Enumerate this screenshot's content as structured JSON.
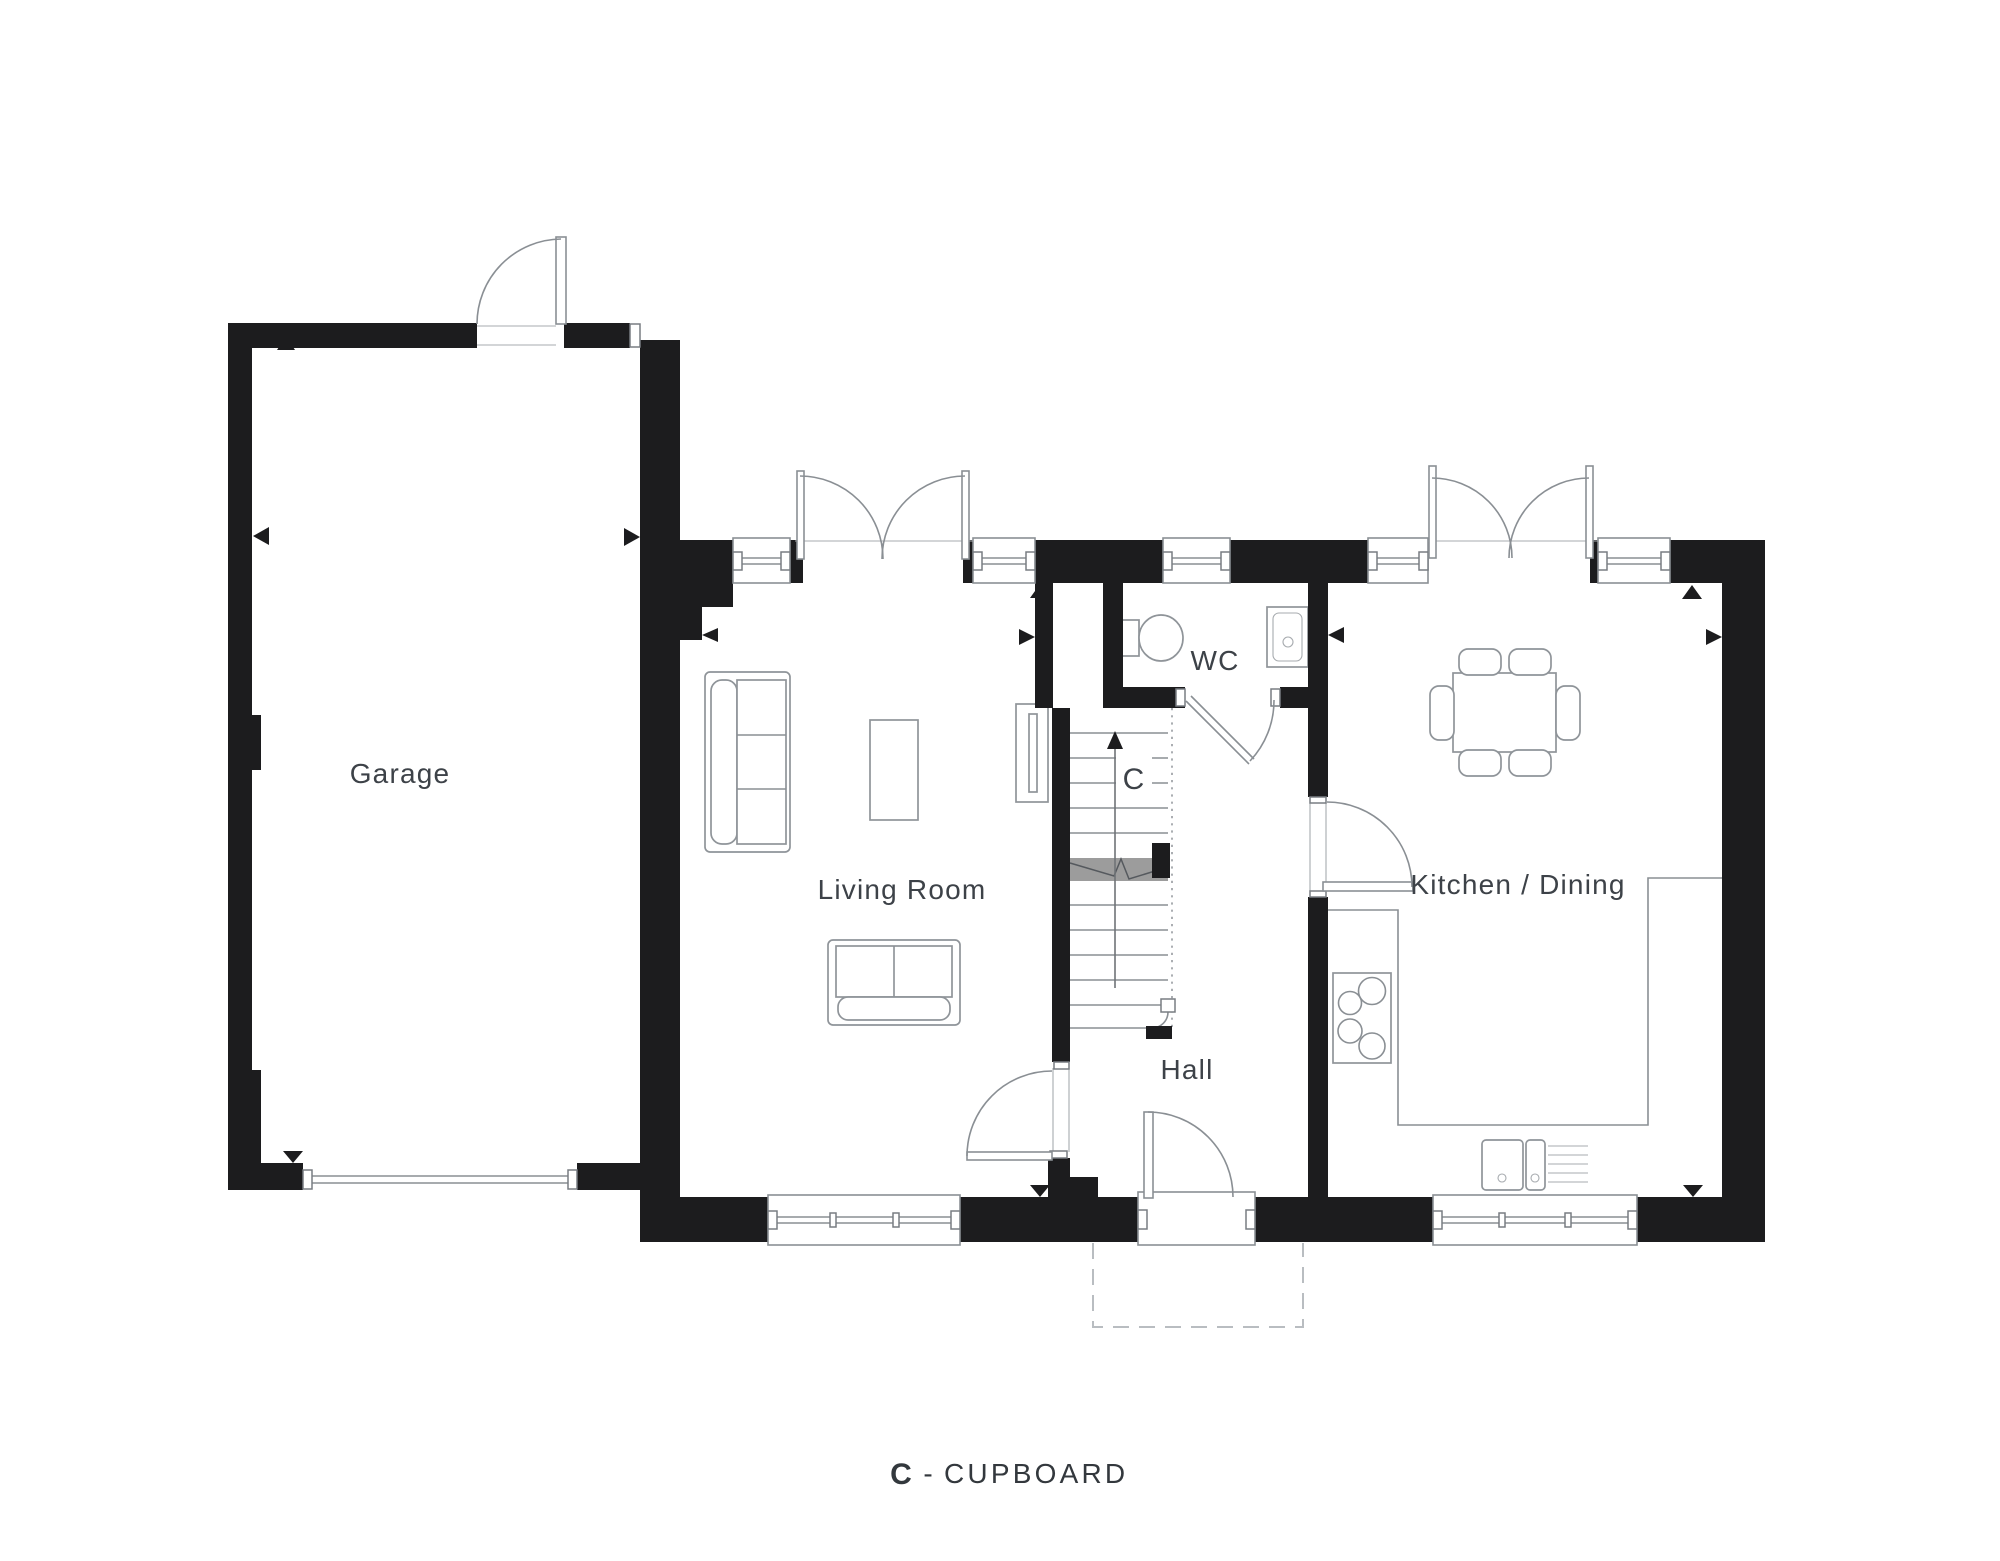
{
  "rooms": {
    "garage": {
      "label": "Garage"
    },
    "living_room": {
      "label": "Living Room"
    },
    "wc": {
      "label": "WC"
    },
    "cupboard": {
      "label": "C"
    },
    "hall": {
      "label": "Hall"
    },
    "kitchen_dining": {
      "label": "Kitchen / Dining"
    }
  },
  "legend": {
    "key": "C",
    "separator": "-",
    "label": "CUPBOARD"
  },
  "colors": {
    "wall": "#1c1c1e",
    "outline": "#8a8f94",
    "label": "#3d4248",
    "stair_break": "#9c9c9c",
    "porch_dash": "#b9bdc1",
    "background": "#ffffff"
  }
}
